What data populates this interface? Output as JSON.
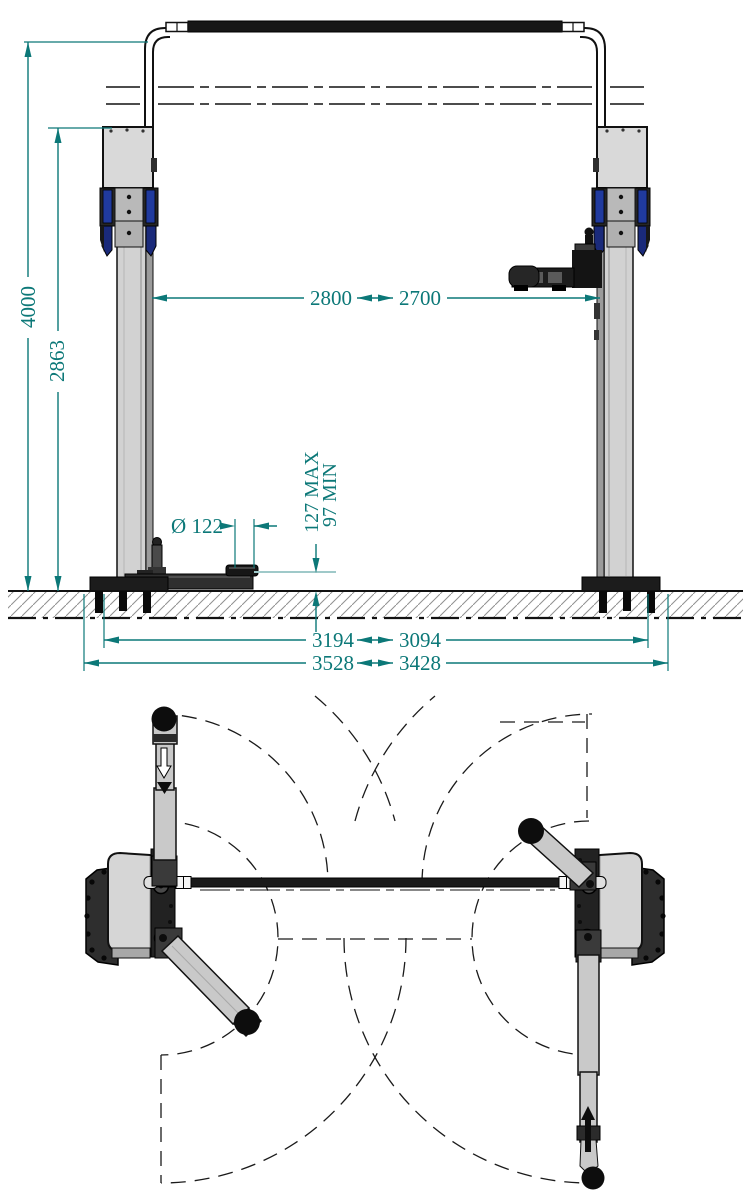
{
  "dimensions": {
    "total_height": "4000",
    "column_height": "2863",
    "clearance_width_max": "2800",
    "clearance_width_min": "2700",
    "pad_diameter": "Ø 122",
    "pad_height_max": "127 MAX",
    "pad_height_min": "97 MIN",
    "baseplate_span_inner_a": "3194",
    "baseplate_span_inner_b": "3094",
    "baseplate_span_outer_a": "3528",
    "baseplate_span_outer_b": "3428"
  },
  "colors": {
    "dimension_teal": "#0c7878",
    "reference_teal_light": "#9fc9c9",
    "structure_light_gray": "#d6d6d6",
    "structure_dark": "#1d1d1d",
    "accent_blue": "#203a9e",
    "hatch_gray": "#909090",
    "background": "#ffffff"
  }
}
